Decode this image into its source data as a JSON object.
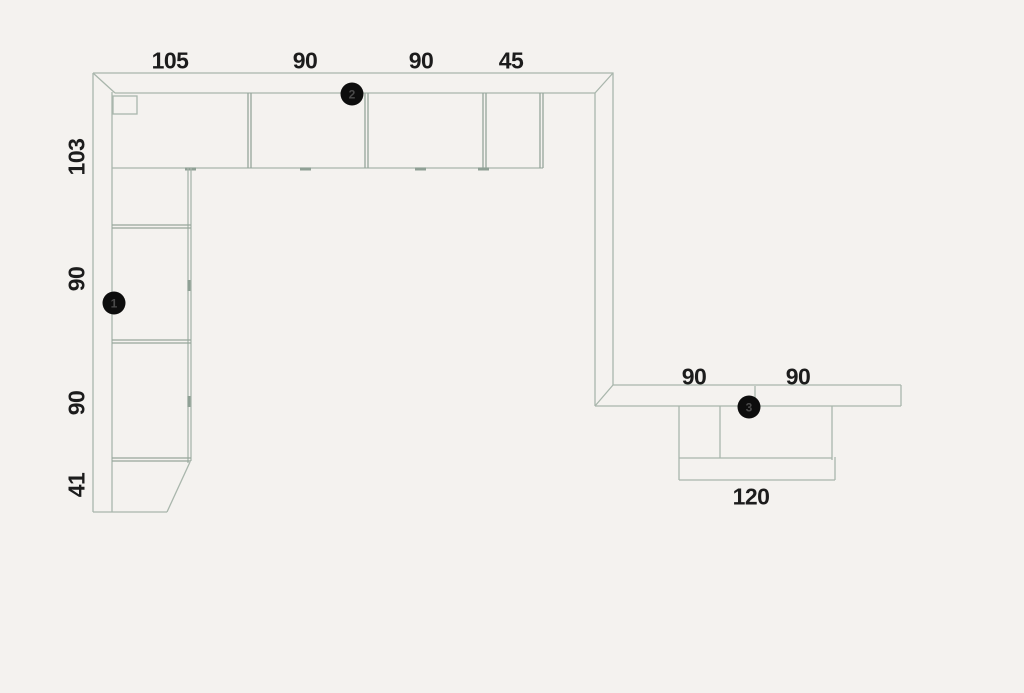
{
  "plan": {
    "type": "kitchen-floor-plan",
    "background_color": "#f4f2ef",
    "line_color": "#a9b6ac",
    "text_color": "#1c1c1c",
    "marker_fill": "#0d0d0d",
    "dimensions": {
      "top_run": [
        {
          "value": "105"
        },
        {
          "value": "90"
        },
        {
          "value": "90"
        },
        {
          "value": "45"
        }
      ],
      "left_run": [
        {
          "value": "103"
        },
        {
          "value": "90"
        },
        {
          "value": "90"
        },
        {
          "value": "41"
        }
      ],
      "right_counter": [
        {
          "value": "90"
        },
        {
          "value": "90"
        }
      ],
      "island": [
        {
          "value": "120"
        }
      ]
    },
    "markers": [
      {
        "number": "1"
      },
      {
        "number": "2"
      },
      {
        "number": "3"
      }
    ]
  }
}
